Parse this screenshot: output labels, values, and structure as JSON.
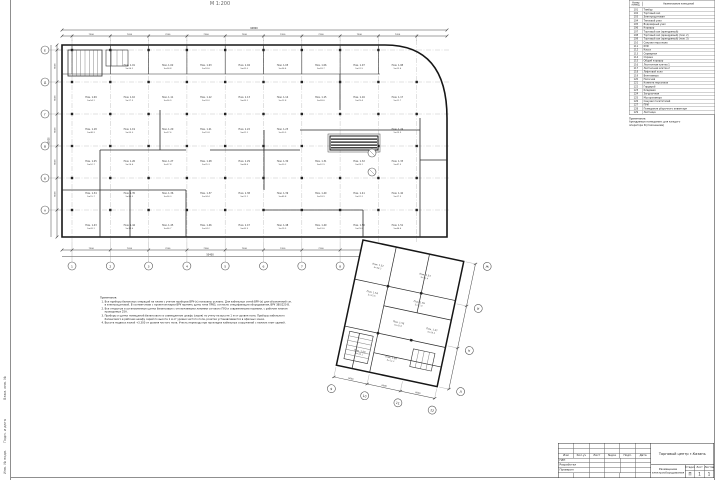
{
  "scale_label": "М 1:200",
  "frame": {
    "side_labels": [
      "Взам. инв. №",
      "Подп. и дата",
      "Инв. № подл."
    ]
  },
  "legend": {
    "col1": "Номер помещ.",
    "col2": "Наименование помещений",
    "rows": [
      [
        "101",
        "Тамбур"
      ],
      [
        "102",
        "Торговый зал"
      ],
      [
        "103",
        "Электрощитовая"
      ],
      [
        "104",
        "Тепловой узел"
      ],
      [
        "105",
        "Водомерный узел"
      ],
      [
        "106",
        "Коридор"
      ],
      [
        "107",
        "Торговый зал (арендуемый)"
      ],
      [
        "108",
        "Торговый зал (арендуемый) (пом. 2)"
      ],
      [
        "109",
        "Торговый зал (арендуемый) (пом. 3)"
      ],
      [
        "110",
        "Санузел персонала"
      ],
      [
        "111",
        "КУИ"
      ],
      [
        "112",
        "Касса"
      ],
      [
        "113",
        "Серверная"
      ],
      [
        "114",
        "Охрана"
      ],
      [
        "115",
        "Общий коридор"
      ],
      [
        "116",
        "Лестничная клетка 1"
      ],
      [
        "117",
        "Лестничная клетка 2"
      ],
      [
        "118",
        "Лифтовой холл"
      ],
      [
        "119",
        "Венткамера"
      ],
      [
        "120",
        "Насосная"
      ],
      [
        "121",
        "Комната персонала"
      ],
      [
        "122",
        "Гардероб"
      ],
      [
        "123",
        "Кладовая"
      ],
      [
        "124",
        "Загрузочная"
      ],
      [
        "125",
        "Мусорокамера"
      ],
      [
        "126",
        "Санузел посетителей"
      ],
      [
        "127",
        "ПУИ"
      ],
      [
        "128",
        "Помещение уборочного инвентаря"
      ],
      [
        "129",
        "Лестница"
      ]
    ],
    "note_title": "Примечание:",
    "note_lines": [
      "Арендуемые помещения: для каждого",
      "оператора N (пояснением)"
    ]
  },
  "notes": {
    "title": "Примечания:",
    "items": [
      "Все приборы балансных операций на плане с учетом приборов ВРУ-(х) показаны условно. Для кабельных сетей ВРУ-(х) для обозначений см. в электрощитовой. В соответствии с проектом марки ВРУ принять щиты типа ПР85, согласно спецификации оборудования, ВРУ 380/220 В.",
      "Все открытые и установленные щитки балансовые с отключаемыми линиями согласно ПУЭ и современными нормами, с рабочим планом проводимых 25А.",
      "Приборы и щитки помещений балансового в совмещенном шкафу (серия) по учету на высоте 1 м от уровня пола. Приборы кабельного балансового в рабочем шкафу серий по высоте 1 м от уровня чистого пола, розетки устанавливаются в офисных зонах.",
      "Высота подвеса жилой +3.300 от уровня чистого пола. Учесть переходы при прокладке кабельных сооружений с нижних плит зданий."
    ]
  },
  "titleblock": {
    "rev_cols": [
      "Изм",
      "Кол.уч",
      "Лист",
      "№док",
      "Подп.",
      "Дата"
    ],
    "roles": [
      "ГИП",
      "Разработал",
      "Проверил"
    ],
    "project": "Торговый центр г.Казань",
    "drawing": "Размещение электрооборудования",
    "stage_label": "Стадия",
    "sheet_label": "Лист",
    "sheets_label": "Листов",
    "stage": "П",
    "sheet": "1",
    "sheets": "1"
  },
  "plan": {
    "axes_x": [
      "1",
      "2",
      "3",
      "4",
      "5",
      "6",
      "7",
      "8"
    ],
    "axes_y": [
      "Е",
      "Д",
      "Г",
      "В",
      "Б",
      "А"
    ],
    "wing_axes_x": [
      "9",
      "10",
      "11",
      "12"
    ],
    "wing_axes_y": [
      "Ж",
      "И",
      "К",
      "Л"
    ],
    "dims": {
      "span_x": "7200",
      "total_x": "64800",
      "span_y": "6000",
      "total_y": "30000",
      "bottom_total": "50400",
      "wing_span": "6000"
    },
    "room_prefix": "Пом.",
    "area_prefix": "S=",
    "rooms": [
      [
        "1.01",
        "36.2"
      ],
      [
        "1.02",
        "24.8"
      ],
      [
        "1.03",
        "18.6"
      ],
      [
        "1.04",
        "42.0"
      ],
      [
        "1.05",
        "36.4"
      ],
      [
        "1.06",
        "28.7"
      ],
      [
        "1.07",
        "31.5"
      ],
      [
        "1.08",
        "22.4"
      ],
      [
        "1.09",
        "54.1"
      ],
      [
        "1.10",
        "17.3"
      ],
      [
        "1.11",
        "26.9"
      ],
      [
        "1.12",
        "33.0"
      ],
      [
        "1.13",
        "45.2"
      ],
      [
        "1.14",
        "12.8"
      ],
      [
        "1.15",
        "38.6"
      ],
      [
        "1.16",
        "29.4"
      ],
      [
        "1.17",
        "21.7"
      ],
      [
        "1.18",
        "48.3"
      ],
      [
        "1.19",
        "35.0"
      ],
      [
        "1.20",
        "27.6"
      ],
      [
        "1.21",
        "19.8"
      ],
      [
        "1.22",
        "41.2"
      ],
      [
        "1.23",
        "30.5"
      ],
      [
        "1.24",
        "23.9"
      ],
      [
        "1.25",
        "52.7"
      ],
      [
        "1.26",
        "16.4"
      ],
      [
        "1.27",
        "37.8"
      ],
      [
        "1.28",
        "25.3"
      ],
      [
        "1.29",
        "44.6"
      ],
      [
        "1.30",
        "20.2"
      ],
      [
        "1.31",
        "32.9"
      ],
      [
        "1.32",
        "28.1"
      ],
      [
        "1.33",
        "47.5"
      ],
      [
        "1.34",
        "15.7"
      ],
      [
        "1.35",
        "39.3"
      ],
      [
        "1.36",
        "26.0"
      ],
      [
        "1.37",
        "34.4"
      ],
      [
        "1.38",
        "22.1"
      ],
      [
        "1.39",
        "49.8"
      ],
      [
        "1.40",
        "18.9"
      ],
      [
        "1.41",
        "31.2"
      ],
      [
        "1.42",
        "27.3"
      ],
      [
        "1.43",
        "43.1"
      ],
      [
        "1.44",
        "14.6"
      ],
      [
        "1.45",
        "36.7"
      ],
      [
        "1.46",
        "24.2"
      ],
      [
        "1.47",
        "40.9"
      ],
      [
        "1.48",
        "19.5"
      ],
      [
        "1.49",
        "33.6"
      ],
      [
        "1.50",
        "29.8"
      ],
      [
        "1.51",
        "46.4"
      ],
      [
        "1.52",
        "58.3"
      ],
      [
        "1.53",
        "21.4"
      ],
      [
        "1.54",
        "35.6"
      ],
      [
        "1.55",
        "17.9"
      ],
      [
        "1.56",
        "42.8"
      ],
      [
        "1.57",
        "26.5"
      ],
      [
        "1.58",
        "30.1"
      ],
      [
        "1.59",
        "12.3"
      ]
    ]
  }
}
